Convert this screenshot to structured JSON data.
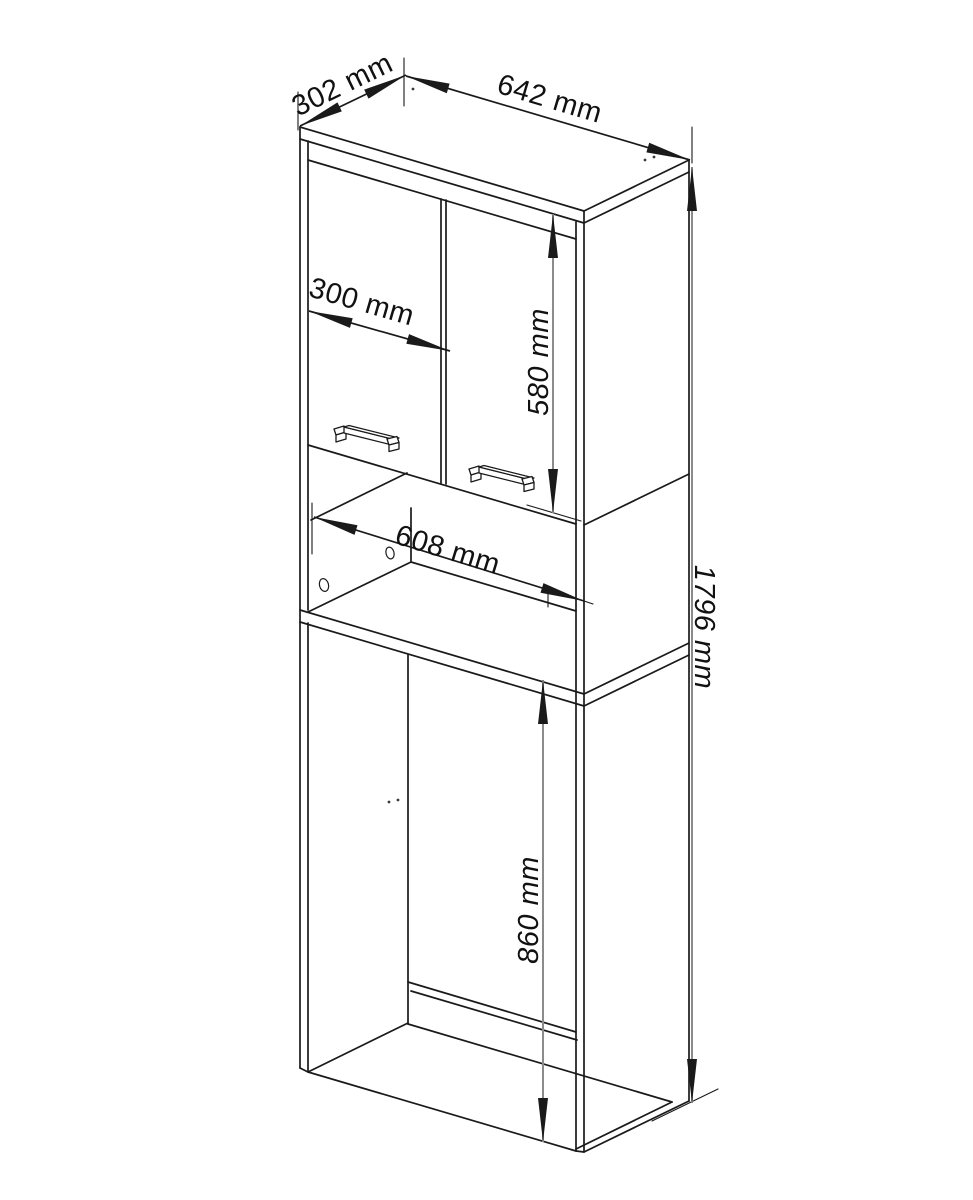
{
  "drawing": {
    "dimensions": {
      "depth": "302 mm",
      "width": "642 mm",
      "door_width": "300 mm",
      "niche_width": "608 mm",
      "door_height": "580 mm",
      "opening_height": "860 mm",
      "total_height": "1796 mm"
    },
    "colors": {
      "line": "#1a1a1a",
      "dimension_gray": "#8b8b8b",
      "background": "#ffffff"
    }
  }
}
